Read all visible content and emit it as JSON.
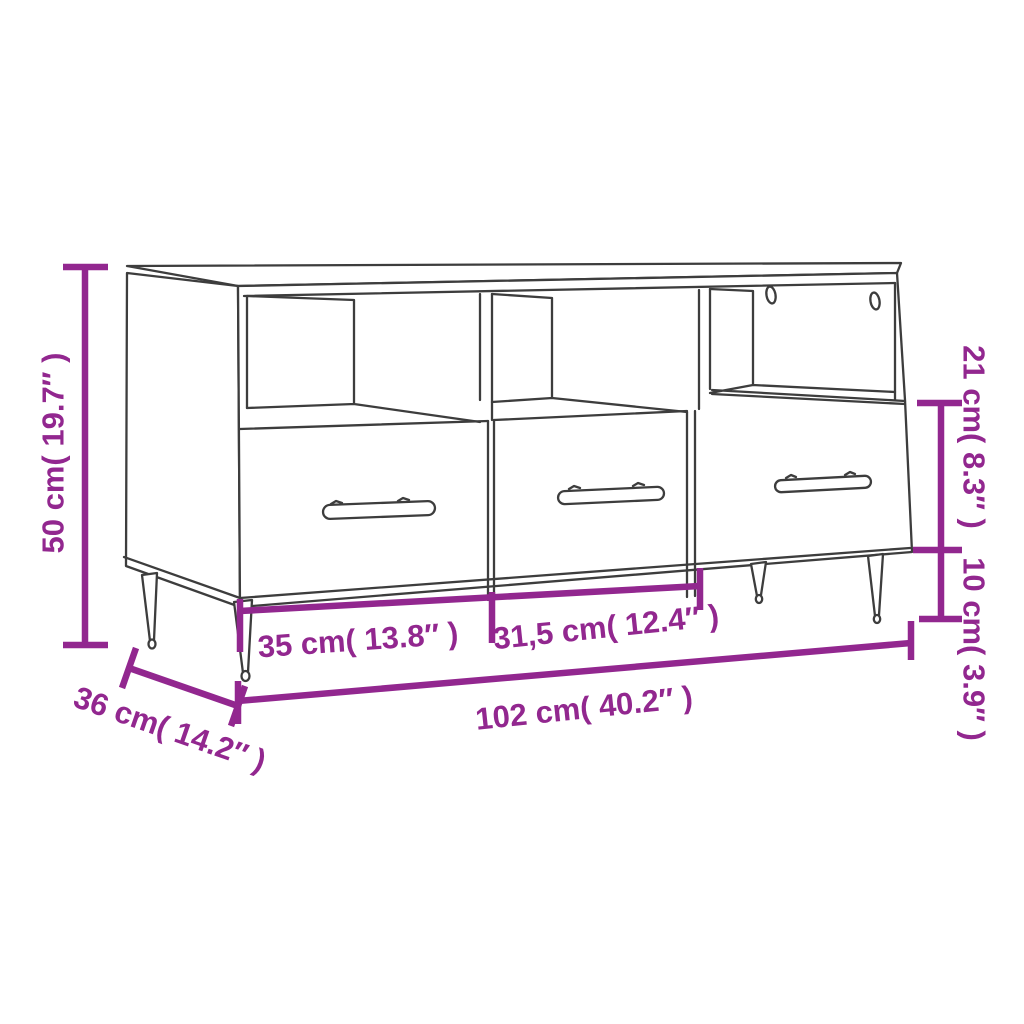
{
  "diagram": {
    "subject": "tv-cabinet-line-drawing",
    "dimension_labels": {
      "height": "50 cm( 19.7″ )",
      "depth": "36 cm( 14.2″ )",
      "left_drawer_width": "35 cm( 13.8″ )",
      "right_drawer_width": "31,5 cm( 12.4″ )",
      "total_width": "102 cm( 40.2″ )",
      "top_section_height": "21 cm( 8.3″ )",
      "leg_height": "10 cm( 3.9″ )"
    },
    "colors": {
      "dimension_annotation": "#92278F",
      "line_art": "#3d3d3d",
      "background": "#ffffff"
    }
  }
}
